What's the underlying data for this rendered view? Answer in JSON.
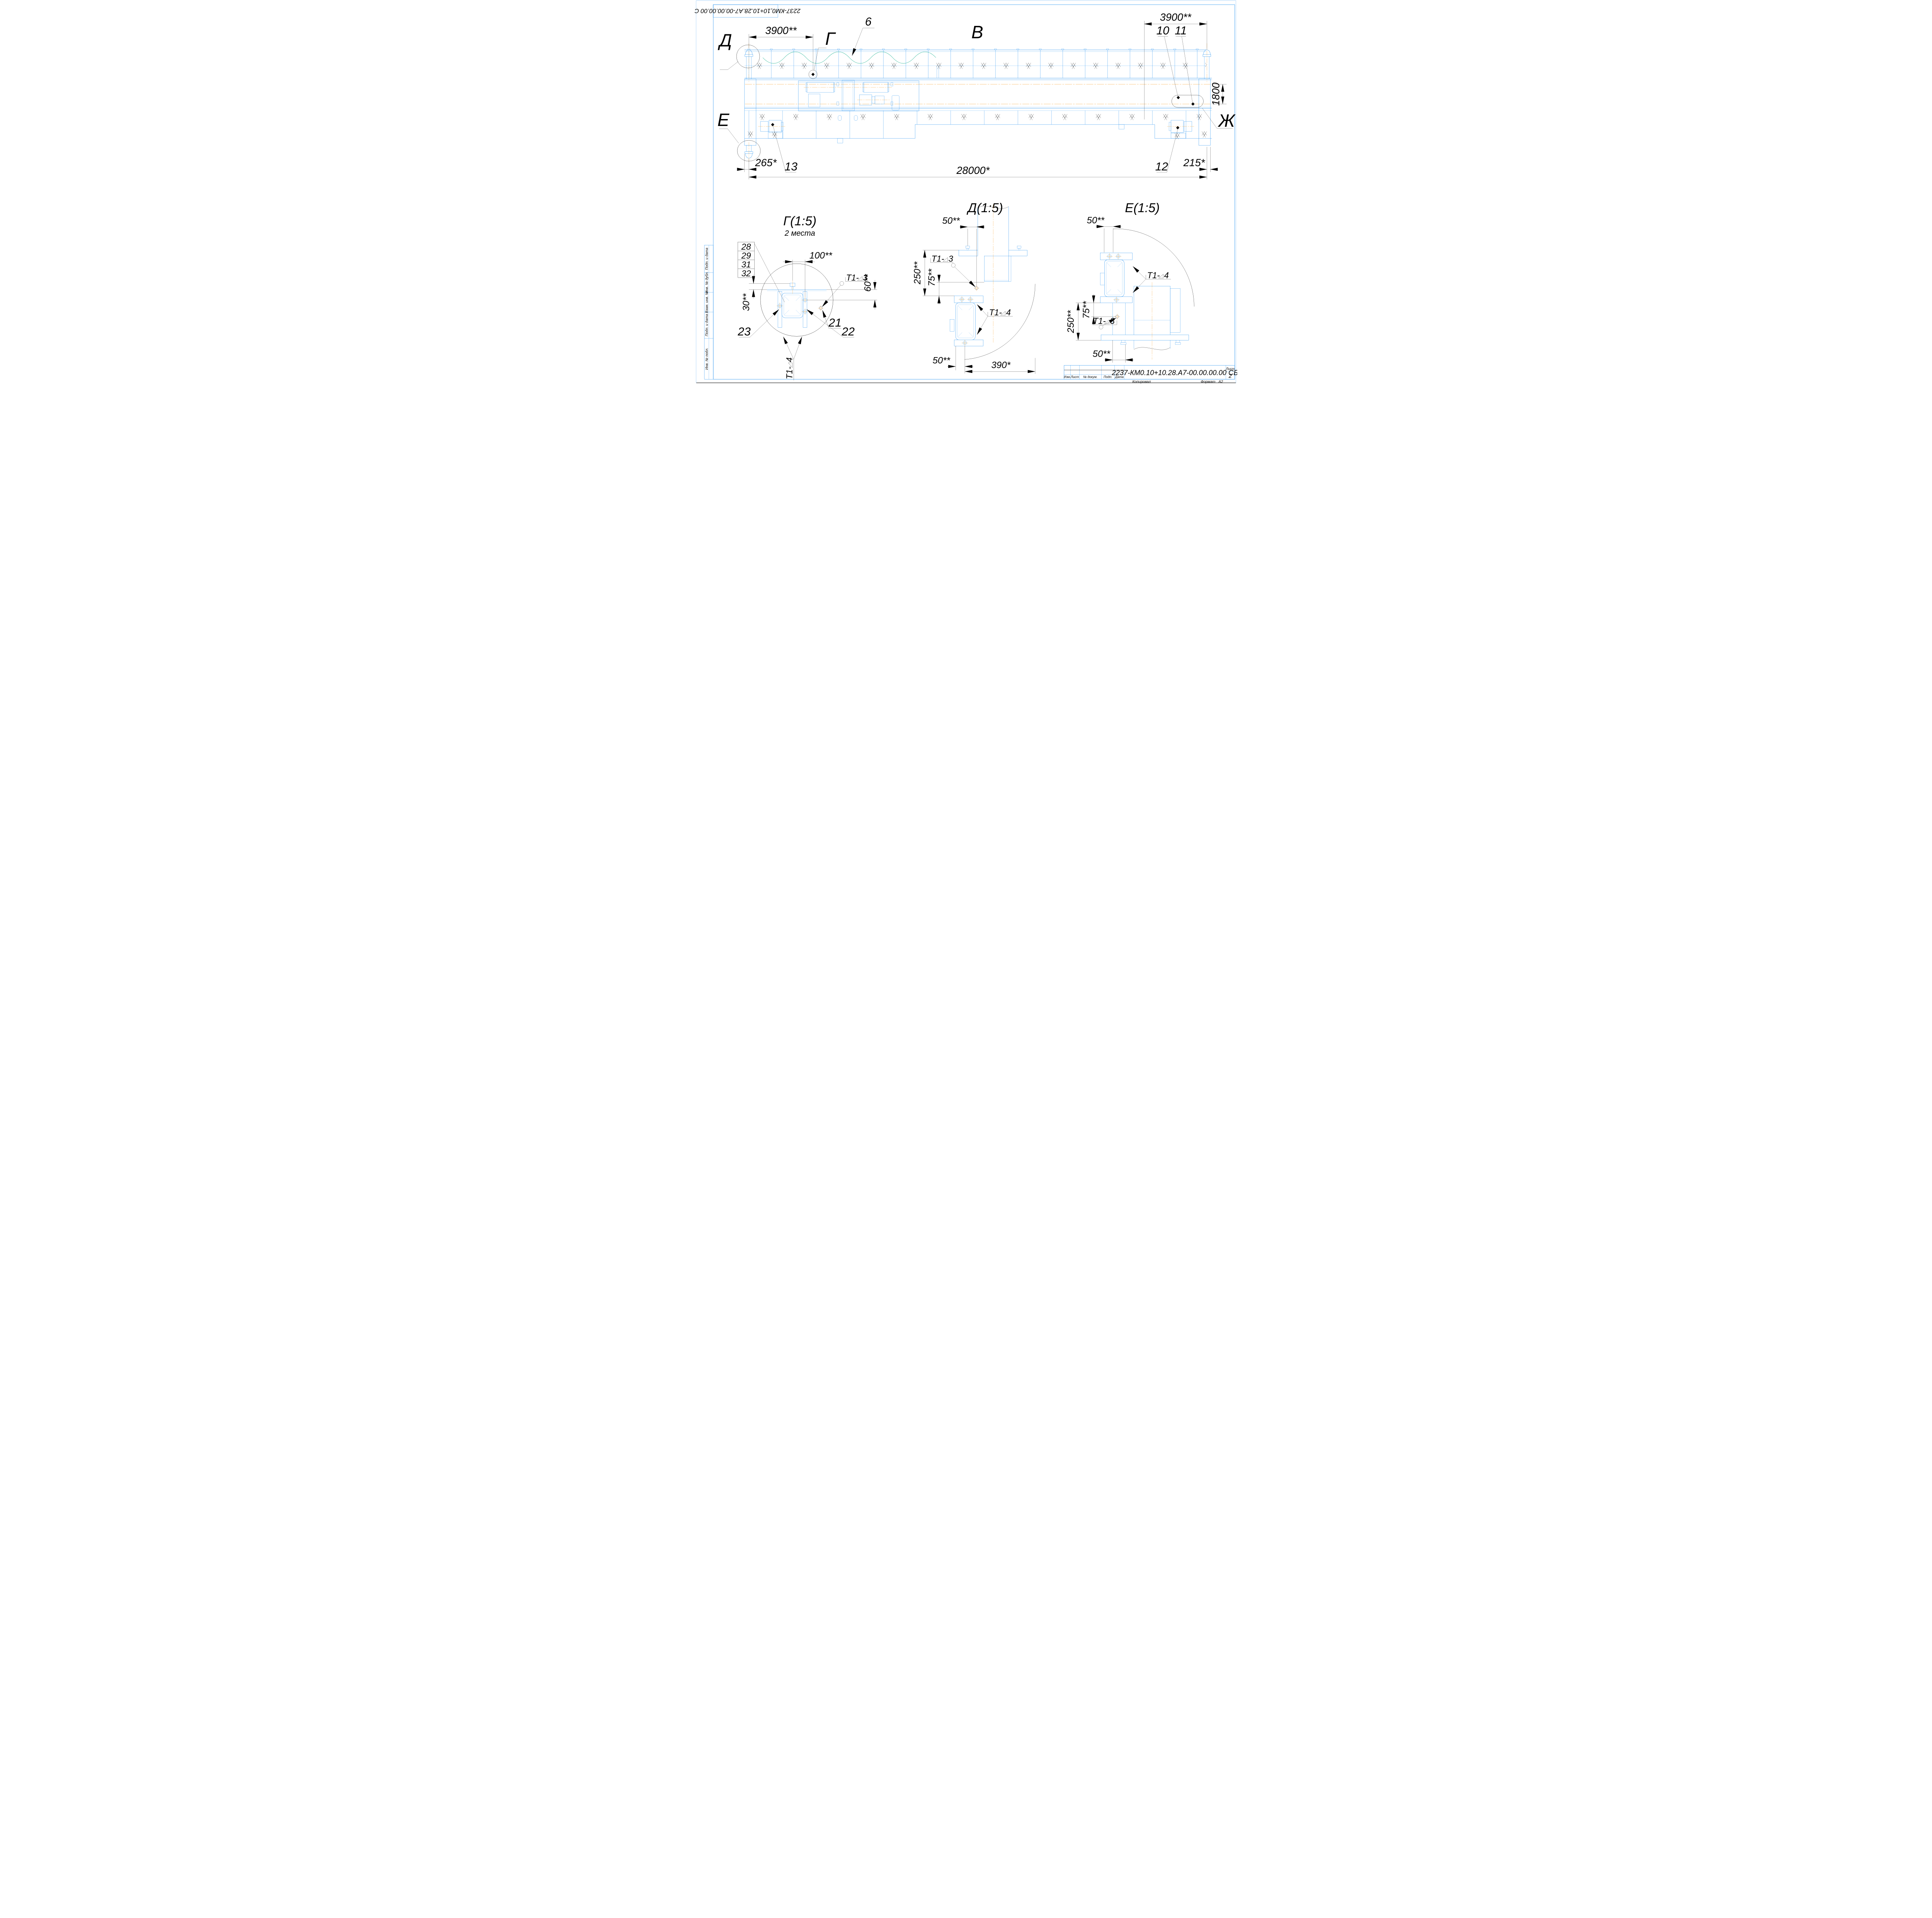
{
  "sheet": {
    "stamp_code": "2237-КМ0,10+10.28.А7-00.00.00.00 СБ"
  },
  "side_stamp": {
    "labels": [
      "Подп. и дата",
      "Инв. № дубл.",
      "Взам. инв. №",
      "Подп. и дата",
      "Инв. № подл."
    ]
  },
  "title_block": {
    "doc_number": "2237-КМ0.10+10.28.А7-00.00.00.00 СБ",
    "columns": [
      "Изм.",
      "Лист",
      "№ докум.",
      "Подп.",
      "Дата"
    ],
    "sheet_label": "Лист",
    "sheet_number": "2",
    "copied_label": "Копировал",
    "format_label": "Формат",
    "format_value": "А2"
  },
  "main_view": {
    "label": "В",
    "dims": {
      "left_3900": "3900**",
      "right_3900": "3900**",
      "span_28000": "28000*",
      "left_265": "265*",
      "right_215": "215*",
      "gauge_1800": "1800"
    },
    "callouts": {
      "c6": "6",
      "c10": "10",
      "c11": "11",
      "c12": "12",
      "c13": "13"
    },
    "views": {
      "d": "Д",
      "g": "Г",
      "e": "Е",
      "zh": "Ж"
    }
  },
  "detail_g": {
    "title": "Г(1:5)",
    "subtitle": "2 места",
    "parts": [
      "28",
      "29",
      "31",
      "32"
    ],
    "dims": {
      "d100": "100**",
      "d60": "60**",
      "d30": "30**"
    },
    "callouts": {
      "c21": "21",
      "c22": "22",
      "c23": "23"
    },
    "welds": {
      "t3_prefix": "Т1-",
      "t3_value": "3",
      "t4_prefix": "Т1-",
      "t4_value": "4"
    }
  },
  "detail_d": {
    "title": "Д(1:5)",
    "dims": {
      "top50": "50**",
      "d250": "250**",
      "d75": "75**",
      "bottom50": "50**",
      "d390": "390*"
    },
    "welds": {
      "t3_prefix": "Т1-",
      "t3_value": "3",
      "t4_prefix": "Т1-",
      "t4_value": "4"
    }
  },
  "detail_e": {
    "title": "Е(1:5)",
    "dims": {
      "top50": "50**",
      "d75": "75**",
      "d250": "250**",
      "bottom50": "50**"
    },
    "welds": {
      "t3_prefix": "Т1-",
      "t3_value": "3",
      "t4_prefix": "Т1-",
      "t4_value": "4"
    }
  }
}
